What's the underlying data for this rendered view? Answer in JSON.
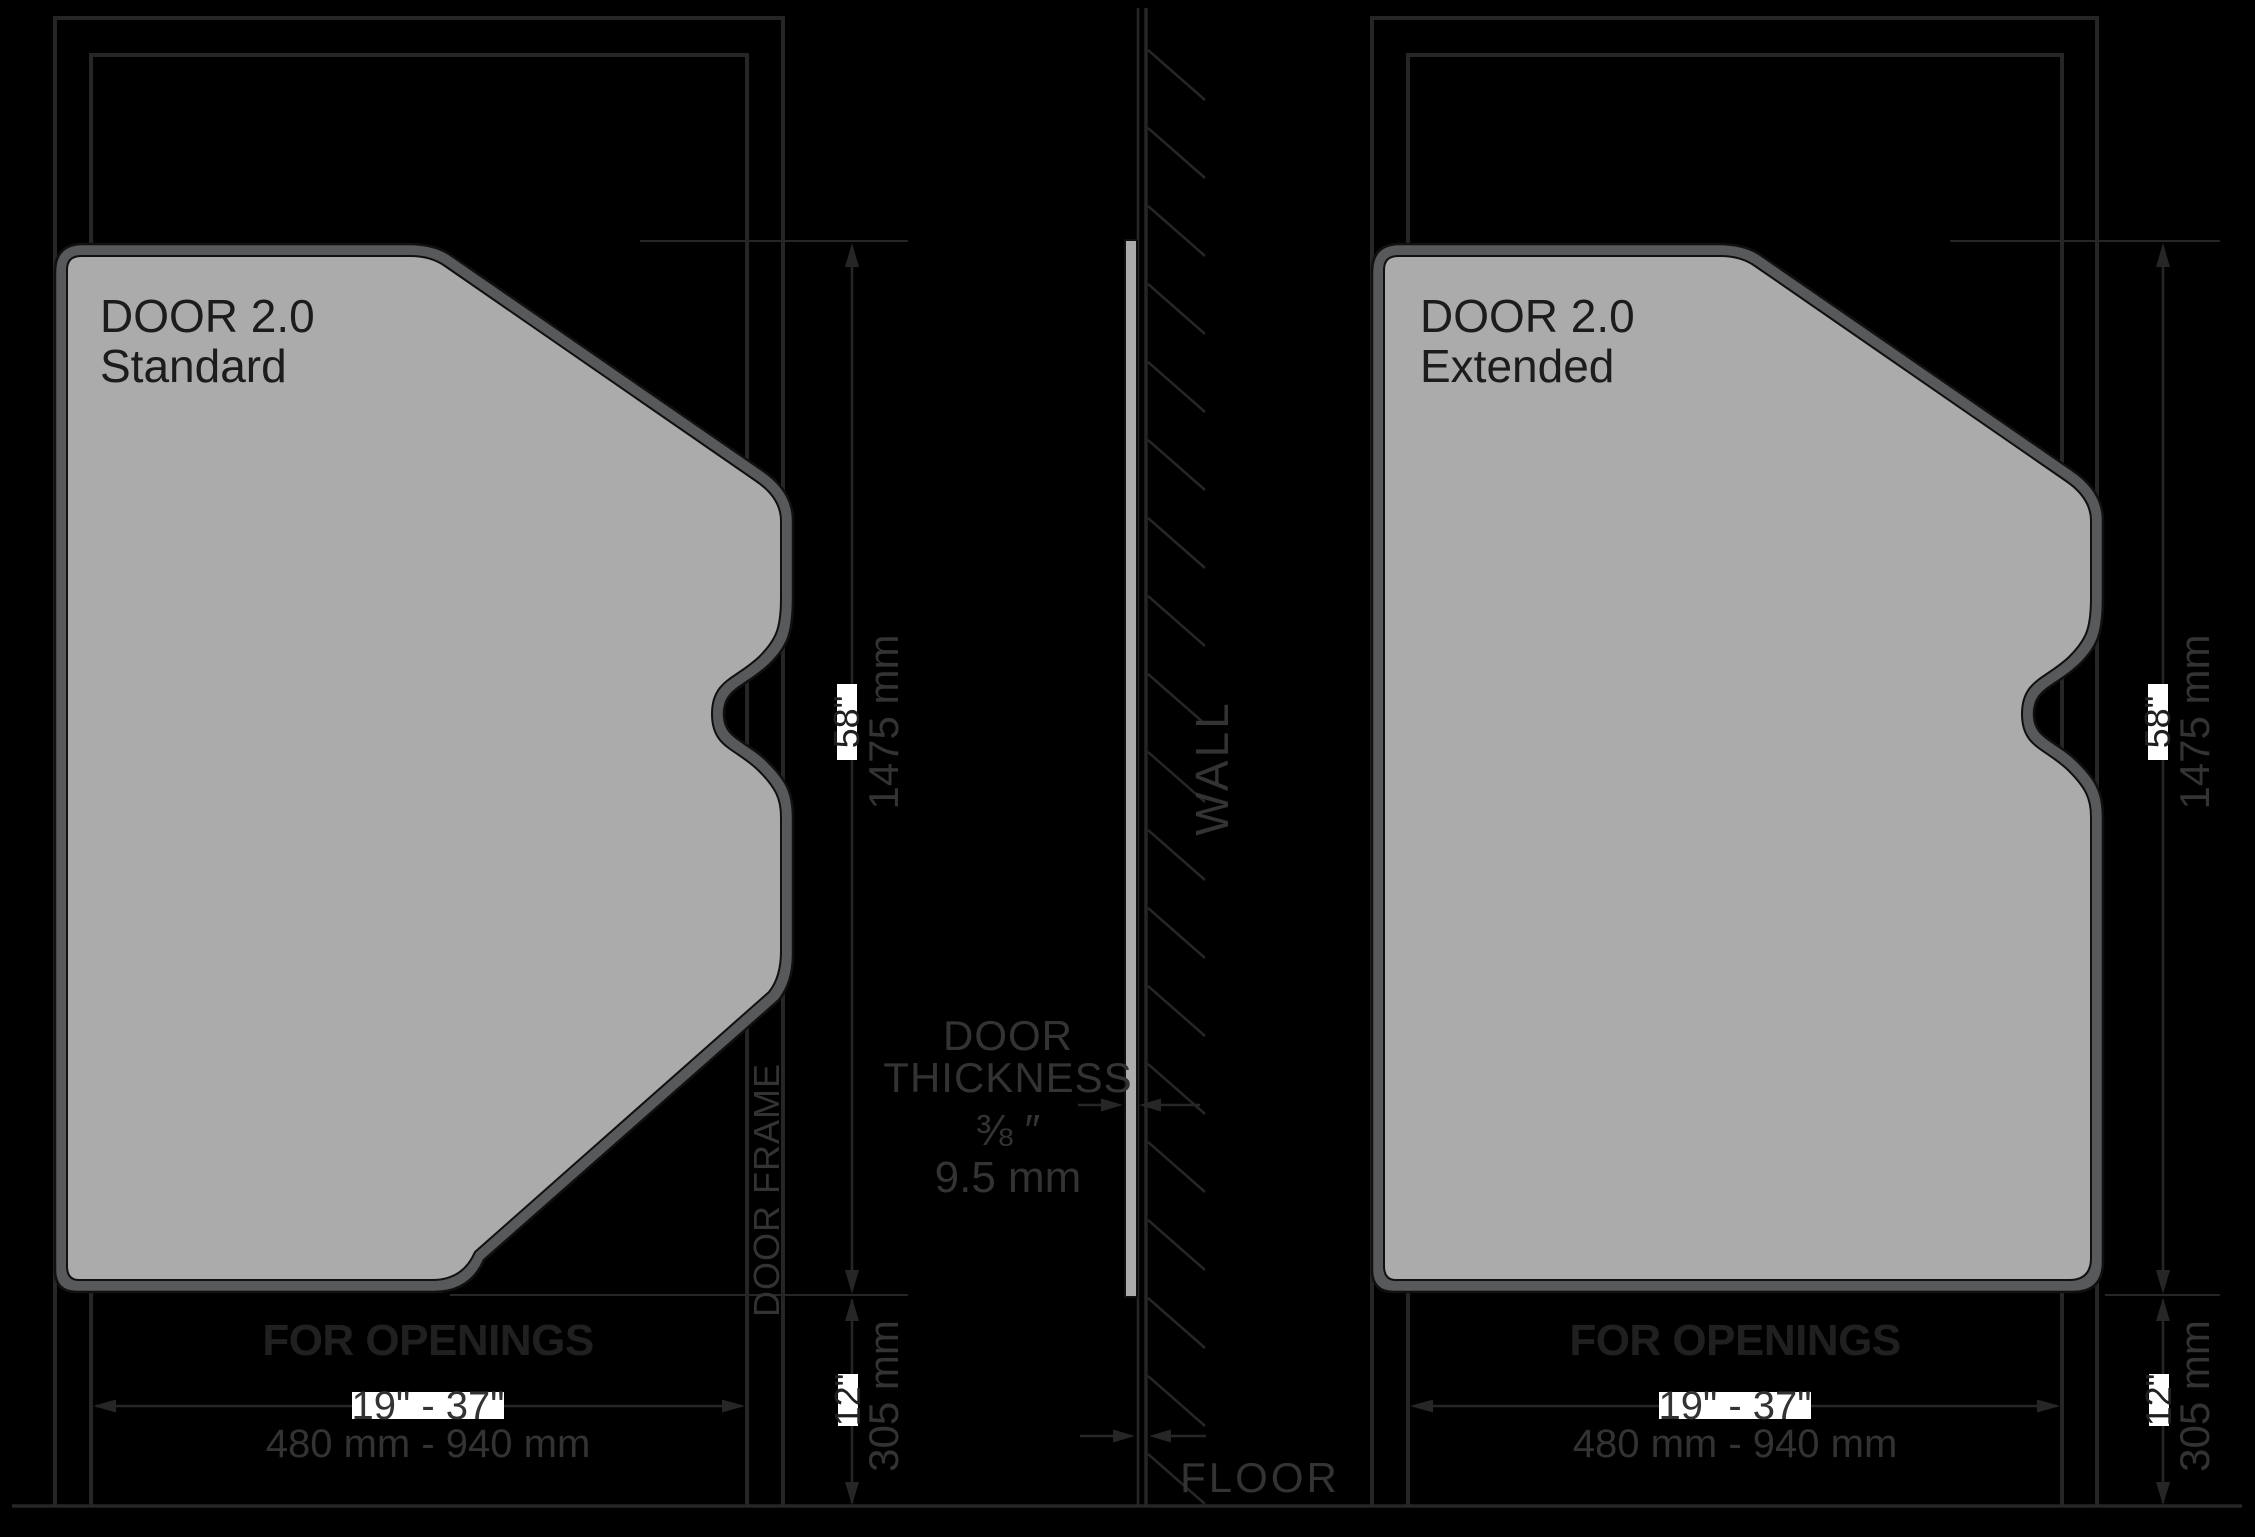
{
  "left_door": {
    "title_line1": "DOOR 2.0",
    "title_line2": "Standard",
    "for_openings_label": "FOR OPENINGS",
    "opening_range_inches": "19\" - 37\"",
    "opening_range_mm": "480 mm - 940 mm",
    "height_inches": "58\"",
    "height_mm": "1475 mm",
    "bottom_gap_inches": "12\"",
    "bottom_gap_mm": "305 mm",
    "door_frame_label": "DOOR FRAME"
  },
  "right_door": {
    "title_line1": "DOOR 2.0",
    "title_line2": "Extended",
    "for_openings_label": "FOR OPENINGS",
    "opening_range_inches": "19\" - 37\"",
    "opening_range_mm": "480 mm - 940 mm",
    "height_inches": "58\"",
    "height_mm": "1475 mm",
    "bottom_gap_inches": "12\"",
    "bottom_gap_mm": "305 mm"
  },
  "center_section": {
    "wall_label": "WALL",
    "floor_label": "FLOOR",
    "door_thickness_label_line1": "DOOR",
    "door_thickness_label_line2": "THICKNESS",
    "thickness_inches": "⅜ ″",
    "thickness_mm": "9.5 mm"
  },
  "colors": {
    "background": "#000000",
    "line_art": "#262626",
    "door_fill": "#ABABAB",
    "door_border": "#58595B",
    "highlight_box": "#ffffff"
  }
}
